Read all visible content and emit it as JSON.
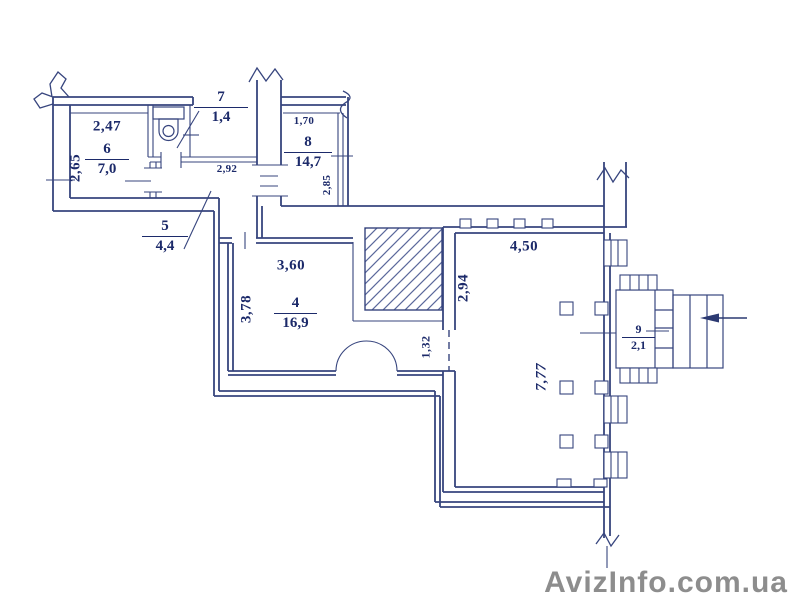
{
  "watermark": {
    "text": "AvizInfo.com.ua"
  },
  "rooms": {
    "r6": {
      "number": "6",
      "area": "7,0"
    },
    "r7": {
      "number": "7",
      "area": "1,4"
    },
    "r5": {
      "number": "5",
      "area": "4,4"
    },
    "r8": {
      "number": "8",
      "area": "14,7"
    },
    "r4": {
      "number": "4",
      "area": "16,9"
    },
    "r9": {
      "number": "9",
      "area": "2,1"
    }
  },
  "dimensions": {
    "d247": "2,47",
    "d265": "2,65",
    "d292": "2,92",
    "d170": "1,70",
    "d285": "2,85",
    "d360": "3,60",
    "d378": "3,78",
    "d450": "4,50",
    "d294": "2,94",
    "d777": "7,77",
    "d132": "1,32"
  },
  "icons": {
    "toilet": "toilet-fixture",
    "entrance_arrow": "entrance-direction-arrow",
    "wall_break": "wall-break-symbol",
    "door_arc": "door-swing-arc",
    "shaft": "hatched-masonry-shaft"
  },
  "colors": {
    "line": "#37457e",
    "text": "#1c2a6a",
    "watermark": "#8d8d8d"
  }
}
